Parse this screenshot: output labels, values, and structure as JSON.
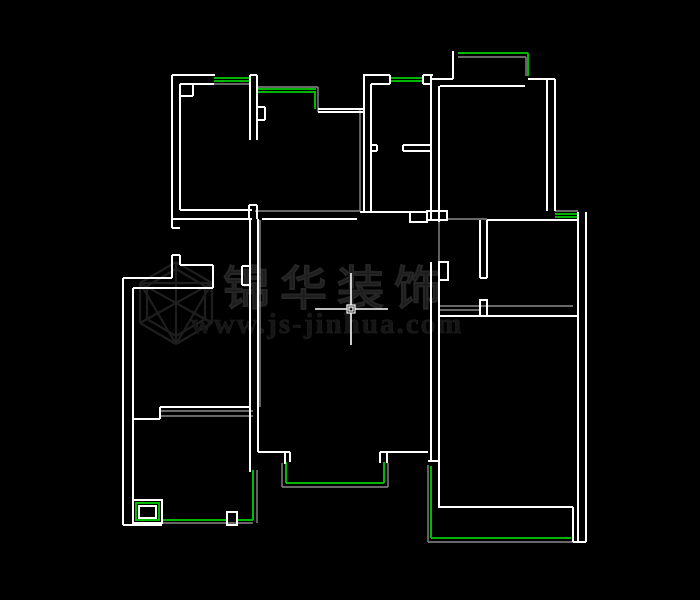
{
  "app": {
    "background": "#000000"
  },
  "watermark": {
    "brand": "锦华装饰",
    "url": "www.js-jinhua.com"
  },
  "colors": {
    "wall": "#ffffff",
    "window": "#00cf00",
    "overlay": "#8a8a8a",
    "logo": "#1e1e1e",
    "cursor": "#ffffff"
  },
  "cursor": {
    "x": 351,
    "y": 309,
    "h_from": 315,
    "h_to": 388,
    "v_from": 273,
    "v_to": 345,
    "box": 8
  },
  "plan": {
    "walls": [
      [
        172,
        75,
        215,
        75
      ],
      [
        172,
        75,
        172,
        228
      ],
      [
        180,
        84,
        180,
        210
      ],
      [
        180,
        84,
        214,
        84
      ],
      [
        193,
        84,
        193,
        96
      ],
      [
        180,
        96,
        193,
        96
      ],
      [
        250,
        75,
        257,
        75
      ],
      [
        250,
        75,
        250,
        140
      ],
      [
        257,
        75,
        257,
        140
      ],
      [
        249,
        205,
        249,
        219
      ],
      [
        257,
        205,
        257,
        219
      ],
      [
        249,
        205,
        257,
        205
      ],
      [
        180,
        210,
        252,
        210
      ],
      [
        172,
        219,
        252,
        219
      ],
      [
        172,
        228,
        180,
        228
      ],
      [
        257,
        107,
        265,
        107
      ],
      [
        265,
        107,
        265,
        120
      ],
      [
        257,
        120,
        265,
        120
      ],
      [
        318,
        109,
        364,
        109
      ],
      [
        318,
        112,
        364,
        112
      ],
      [
        363,
        75,
        390,
        75
      ],
      [
        364,
        75,
        364,
        213
      ],
      [
        371,
        84,
        371,
        213
      ],
      [
        371,
        84,
        390,
        84
      ],
      [
        390,
        75,
        390,
        84
      ],
      [
        423,
        75,
        423,
        84
      ],
      [
        423,
        75,
        433,
        75
      ],
      [
        423,
        84,
        431,
        84
      ],
      [
        431,
        75,
        431,
        220
      ],
      [
        439,
        86,
        439,
        222
      ],
      [
        403,
        145,
        430,
        145
      ],
      [
        403,
        151,
        430,
        151
      ],
      [
        403,
        145,
        403,
        151
      ],
      [
        371,
        145,
        377,
        145
      ],
      [
        377,
        145,
        377,
        151
      ],
      [
        371,
        151,
        377,
        151
      ],
      [
        360,
        212,
        410,
        212
      ],
      [
        427,
        220,
        447,
        220
      ],
      [
        431,
        79,
        453,
        79
      ],
      [
        453,
        51,
        453,
        79
      ],
      [
        528,
        79,
        555,
        79
      ],
      [
        440,
        86,
        525,
        86
      ],
      [
        547,
        79,
        547,
        211
      ],
      [
        555,
        79,
        555,
        211
      ],
      [
        487,
        220,
        577,
        220
      ],
      [
        480,
        220,
        480,
        278
      ],
      [
        487,
        220,
        487,
        278
      ],
      [
        480,
        278,
        487,
        278
      ],
      [
        431,
        262,
        431,
        461
      ],
      [
        439,
        280,
        439,
        508
      ],
      [
        428,
        461,
        440,
        461
      ],
      [
        440,
        316,
        577,
        316
      ],
      [
        438,
        507,
        573,
        507
      ],
      [
        573,
        507,
        573,
        542
      ],
      [
        578,
        212,
        578,
        542
      ],
      [
        586,
        212,
        586,
        542
      ],
      [
        573,
        542,
        586,
        542
      ],
      [
        258,
        452,
        290,
        452
      ],
      [
        290,
        452,
        290,
        462
      ],
      [
        285,
        452,
        285,
        464
      ],
      [
        380,
        452,
        380,
        463
      ],
      [
        387,
        452,
        387,
        463
      ],
      [
        380,
        452,
        428,
        452
      ],
      [
        250,
        219,
        250,
        472
      ],
      [
        258,
        219,
        258,
        452
      ],
      [
        242,
        266,
        250,
        266
      ],
      [
        242,
        266,
        242,
        285
      ],
      [
        242,
        285,
        250,
        285
      ],
      [
        172,
        255,
        172,
        278
      ],
      [
        172,
        255,
        180,
        255
      ],
      [
        180,
        255,
        180,
        265
      ],
      [
        180,
        265,
        213,
        265
      ],
      [
        213,
        265,
        213,
        288
      ],
      [
        123,
        278,
        172,
        278
      ],
      [
        133,
        288,
        213,
        288
      ],
      [
        123,
        278,
        123,
        525
      ],
      [
        133,
        288,
        133,
        500
      ],
      [
        160,
        407,
        250,
        407
      ],
      [
        133,
        419,
        160,
        419
      ],
      [
        160,
        407,
        160,
        419
      ],
      [
        123,
        525,
        162,
        525
      ],
      [
        262,
        219,
        357,
        219
      ]
    ],
    "wall_rects": [
      [
        410,
        212,
        17,
        10
      ],
      [
        427,
        211,
        20,
        9
      ],
      [
        480,
        300,
        7,
        16
      ],
      [
        439,
        262,
        9,
        18
      ],
      [
        227,
        512,
        10,
        13
      ],
      [
        133,
        500,
        29,
        23
      ],
      [
        139,
        506,
        17,
        12
      ]
    ],
    "windows": [
      [
        214,
        78,
        250,
        78
      ],
      [
        214,
        81,
        250,
        81
      ],
      [
        257,
        89,
        316,
        89
      ],
      [
        257,
        92,
        316,
        92
      ],
      [
        315,
        92,
        315,
        109
      ],
      [
        390,
        78,
        423,
        78
      ],
      [
        390,
        81,
        423,
        81
      ],
      [
        458,
        53,
        528,
        53
      ],
      [
        528,
        53,
        528,
        76
      ],
      [
        555,
        214,
        578,
        214
      ],
      [
        555,
        217,
        578,
        217
      ],
      [
        286,
        462,
        286,
        483
      ],
      [
        286,
        483,
        384,
        483
      ],
      [
        384,
        462,
        384,
        483
      ],
      [
        253,
        470,
        253,
        520
      ],
      [
        162,
        520,
        227,
        520
      ],
      [
        237,
        520,
        253,
        520
      ],
      [
        431,
        466,
        431,
        538
      ],
      [
        431,
        538,
        571,
        538
      ]
    ],
    "window_rects": [
      [
        136,
        503,
        23,
        17
      ]
    ],
    "overlay": [
      [
        214,
        84,
        250,
        84
      ],
      [
        257,
        87,
        318,
        87
      ],
      [
        318,
        87,
        318,
        112
      ],
      [
        458,
        57,
        526,
        57
      ],
      [
        526,
        57,
        526,
        76
      ],
      [
        255,
        211,
        360,
        211
      ],
      [
        360,
        110,
        360,
        211
      ],
      [
        447,
        219,
        487,
        219
      ],
      [
        439,
        222,
        439,
        262
      ],
      [
        555,
        211,
        578,
        211
      ],
      [
        440,
        306,
        573,
        306
      ],
      [
        440,
        310,
        480,
        310
      ],
      [
        260,
        220,
        260,
        407
      ],
      [
        160,
        411,
        253,
        411
      ],
      [
        160,
        416,
        253,
        416
      ],
      [
        282,
        463,
        282,
        487
      ],
      [
        282,
        487,
        388,
        487
      ],
      [
        388,
        463,
        388,
        487
      ],
      [
        162,
        523,
        253,
        523
      ],
      [
        257,
        470,
        257,
        523
      ],
      [
        428,
        465,
        428,
        542
      ],
      [
        428,
        542,
        573,
        542
      ]
    ],
    "logo_lines": [
      [
        176,
        262,
        212,
        283
      ],
      [
        212,
        283,
        212,
        323
      ],
      [
        212,
        323,
        176,
        344
      ],
      [
        176,
        344,
        140,
        323
      ],
      [
        140,
        323,
        140,
        283
      ],
      [
        140,
        283,
        176,
        262
      ],
      [
        176,
        269,
        205,
        286
      ],
      [
        205,
        286,
        205,
        319
      ],
      [
        205,
        319,
        176,
        336
      ],
      [
        176,
        336,
        147,
        319
      ],
      [
        147,
        319,
        147,
        286
      ],
      [
        147,
        286,
        176,
        269
      ],
      [
        176,
        303,
        176,
        344
      ],
      [
        176,
        303,
        140,
        283
      ],
      [
        176,
        303,
        212,
        283
      ],
      [
        140,
        283,
        176,
        344
      ],
      [
        176,
        303,
        140,
        323
      ],
      [
        212,
        283,
        176,
        344
      ],
      [
        176,
        303,
        212,
        323
      ],
      [
        140,
        283,
        212,
        283
      ],
      [
        176,
        262,
        176,
        303
      ]
    ]
  },
  "text_layout": {
    "brand_x": 337,
    "brand_y": 305,
    "url_x": 327,
    "url_y": 333
  }
}
